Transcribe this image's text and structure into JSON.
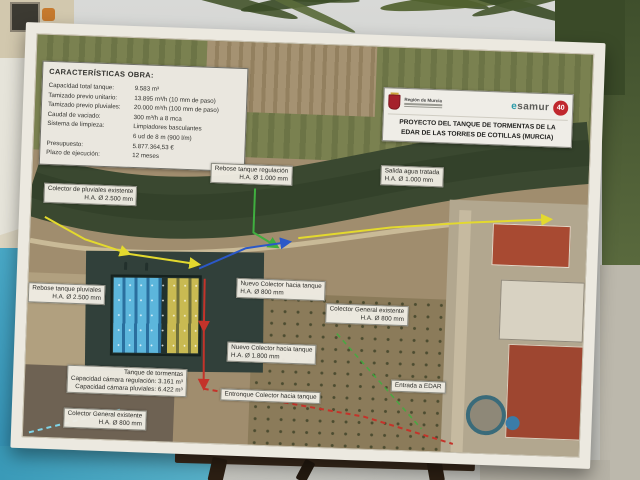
{
  "specs": {
    "heading": "CARACTERÍSTICAS OBRA:",
    "rows": [
      {
        "label": "Capacidad total tanque:",
        "value": "9.583 m³"
      },
      {
        "label": "Tamizado previo unitario:",
        "value": "13.895 m³/h (10 mm de paso)"
      },
      {
        "label": "Tamizado previo pluviales:",
        "value": "20.000 m³/h (100 mm de paso)"
      },
      {
        "label": "Caudal de vaciado:",
        "value": "300 m³/h a 8 mca"
      },
      {
        "label": "Sistema de limpieza:",
        "value": "Limpiadores basculantes"
      },
      {
        "label": "",
        "value": "6 ud de 8 m (900 l/m)"
      },
      {
        "label": "Presupuesto:",
        "value": "5.877.364,53 €"
      },
      {
        "label": "Plazo de ejecución:",
        "value": "12 meses"
      }
    ]
  },
  "title_box": {
    "org": "Región de Murcia",
    "esamur": "esamur",
    "badge": "40",
    "line1": "PROYECTO DEL TANQUE DE TORMENTAS DE LA",
    "line2": "EDAR DE LAS TORRES DE COTILLAS (MURCIA)"
  },
  "labels": [
    {
      "l1": "Rebose tanque regulación",
      "l2": "H.A. Ø 1.000 mm"
    },
    {
      "l1": "Salida agua tratada",
      "l2": "H.A. Ø 1.000 mm"
    },
    {
      "l1": "Colector de pluviales existente",
      "l2": "H.A. Ø 2.500 mm"
    },
    {
      "l1": "Rebose tanque pluviales",
      "l2": "H.A. Ø 2.500 mm"
    },
    {
      "l1": "Nuevo Colector hacia tanque",
      "l2": "H.A. Ø 800 mm"
    },
    {
      "l1": "Colector General existente",
      "l2": "H.A. Ø 800 mm"
    },
    {
      "l1": "Nuevo Colector hacia tanque",
      "l2": "H.A. Ø 1.800 mm"
    },
    {
      "l1": "Tanque de tormentas",
      "l2": "Capacidad cámara regulación: 3.161 m³",
      "l3": "Capacidad cámara pluviales: 6.422 m³"
    },
    {
      "l1": "Entronque Colector hacia tanque"
    },
    {
      "l1": "Entrada a EDAR"
    },
    {
      "l1": "Colector General existente",
      "l2": "H.A. Ø 800 mm"
    }
  ],
  "colors": {
    "pipe_yellow": "#e3d92e",
    "pipe_green": "#3fae3f",
    "pipe_blue": "#2b58c8",
    "pipe_red": "#c4332a",
    "pipe_cyan": "#7fd4e8",
    "badge_red": "#c0272d",
    "shield_red": "#a5212c"
  }
}
